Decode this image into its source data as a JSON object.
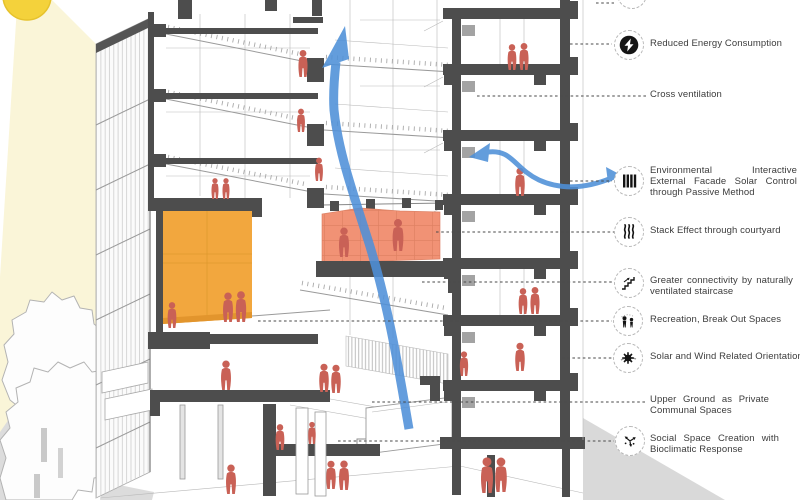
{
  "annotations": {
    "items": [
      {
        "id": "reduced-energy",
        "icon": "energy-bolt",
        "label": "Reduced Energy Consumption"
      },
      {
        "id": "cross-ventilation",
        "icon": "none",
        "label": "Cross ventilation"
      },
      {
        "id": "environmental-facade",
        "icon": "louver-facade",
        "label": "Environmental Interactive External Facade Solar Control through Passive Method"
      },
      {
        "id": "stack-effect",
        "icon": "stack-waves",
        "label": "Stack Effect through courtyard"
      },
      {
        "id": "staircase-connectivity",
        "icon": "staircase",
        "label": "Greater connectivity by naturally ventilated staircase"
      },
      {
        "id": "recreation",
        "icon": "people",
        "label": "Recreation, Break Out Spaces"
      },
      {
        "id": "solar-wind",
        "icon": "sun-orientation",
        "label": "Solar and Wind Related Orientation"
      },
      {
        "id": "upper-ground",
        "icon": "none",
        "label": "Upper Ground as Private Communal Spaces"
      },
      {
        "id": "social-space",
        "icon": "radiating-arrows",
        "label": "Social Space Creation with Bioclimatic Response"
      }
    ]
  },
  "colors": {
    "airflow_blue": "#4E90D8",
    "highlight_amber": "#F2A73E",
    "highlight_salmon": "#F19275",
    "figure_red": "#C96156",
    "section_cut_dark": "#4D4D4D",
    "sun_yellow": "#F4D23B",
    "sunbeam_pale": "#FAF5D8",
    "ground_gray": "#DBDBDB",
    "leader_line": "#4A4A4A"
  }
}
